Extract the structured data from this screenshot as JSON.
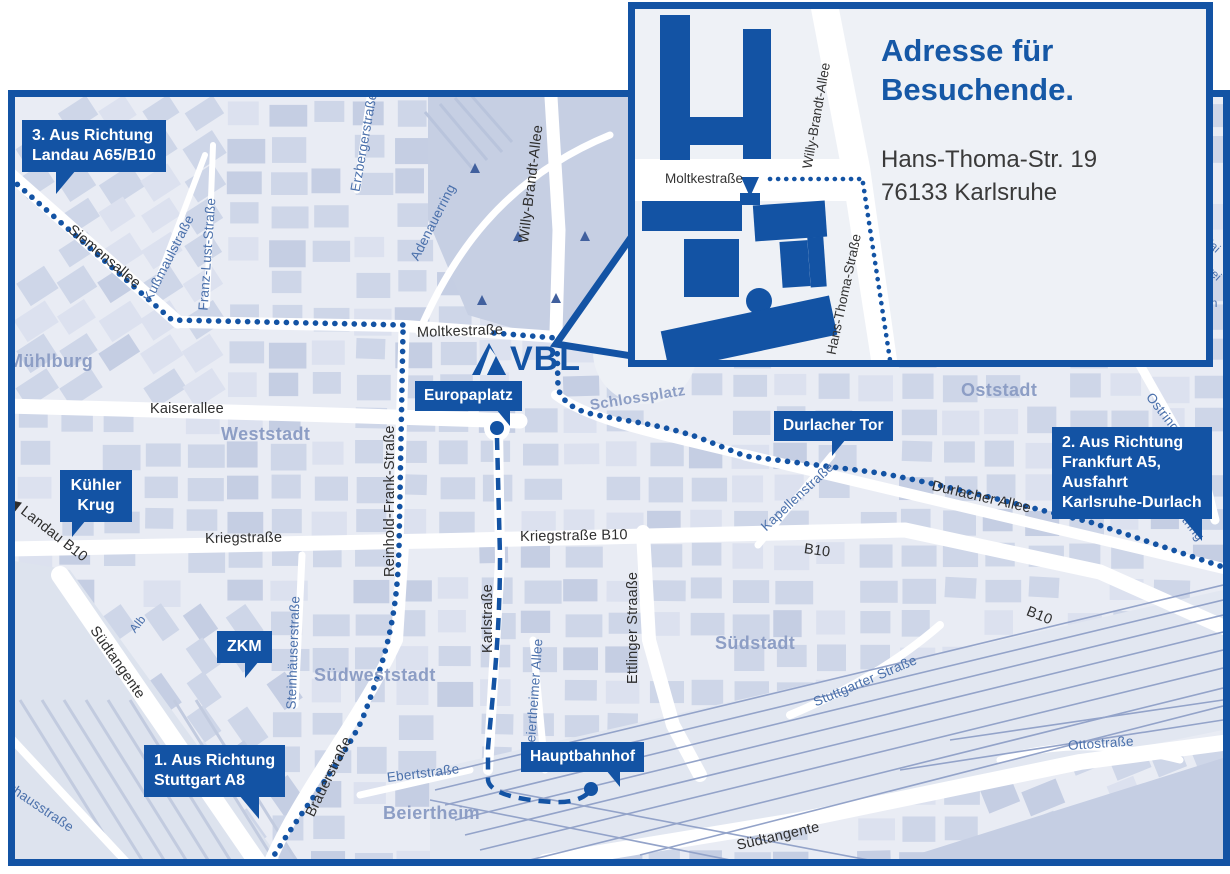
{
  "title": "VBL Anfahrtsplan Karlsruhe",
  "colors": {
    "accent": "#1353a4",
    "heading": "#1658a6",
    "mapBg": "#e9ecf4",
    "block": "#ced6e8",
    "blockLight": "#dce1ef",
    "blockDark": "#c5cee3",
    "park": "#c6cfe3",
    "railZone": "#e2e7f1",
    "rail": "#93a3c9",
    "district": "#8d9ec5",
    "streetDark": "#2e2e2e",
    "streetBlue": "#4a70ab",
    "insetBg": "#eef1f6",
    "addressText": "#3a3a3a"
  },
  "logo": {
    "text": "VBL"
  },
  "inset": {
    "heading": "Adresse für Besuchende.",
    "address_line1": "Hans-Thoma-Str. 19",
    "address_line2": "76133 Karlsruhe",
    "streets": [
      {
        "id": "moltke_inset",
        "label": "Moltkestraße"
      },
      {
        "id": "willy_inset",
        "label": "Willy-Brandt-Allee"
      },
      {
        "id": "hans_thoma_inset",
        "label": "Hans-Thoma-Straße"
      }
    ]
  },
  "callouts": {
    "route3": {
      "lines": [
        "3. Aus Richtung",
        "Landau A65/B10"
      ]
    },
    "kuehler_krug": {
      "lines": [
        "Kühler",
        "Krug"
      ]
    },
    "zkm": {
      "lines": [
        "ZKM"
      ]
    },
    "route1": {
      "lines": [
        "1. Aus Richtung",
        "Stuttgart A8"
      ]
    },
    "europaplatz": {
      "lines": [
        "Europaplatz"
      ]
    },
    "durlacher_tor": {
      "lines": [
        "Durlacher Tor"
      ]
    },
    "route2": {
      "lines": [
        "2. Aus Richtung",
        "Frankfurt A5,",
        "Ausfahrt",
        "Karlsruhe-Durlach"
      ]
    },
    "hauptbahnhof": {
      "lines": [
        "Hauptbahnhof"
      ]
    }
  },
  "districts": [
    {
      "id": "muehlburg",
      "label": "Mühlburg"
    },
    {
      "id": "weststadt",
      "label": "Weststadt"
    },
    {
      "id": "oststadt",
      "label": "Oststadt"
    },
    {
      "id": "suedstadt",
      "label": "Südstadt"
    },
    {
      "id": "suedweststadt",
      "label": "Südweststadt"
    },
    {
      "id": "beiertheim",
      "label": "Beiertheim"
    },
    {
      "id": "schlossplatz",
      "label": "Schlossplatz"
    }
  ],
  "streets": [
    {
      "id": "siemensallee",
      "label": "Siemensallee"
    },
    {
      "id": "kussmaulstrasse",
      "label": "Kußmaulstraße"
    },
    {
      "id": "franz_lust",
      "label": "Franz-Lust-Straße"
    },
    {
      "id": "erzbergerstrasse",
      "label": "Erzbergerstraße"
    },
    {
      "id": "kaiserallee",
      "label": "Kaiserallee"
    },
    {
      "id": "moltkestrasse",
      "label": "Moltkestraße"
    },
    {
      "id": "willy_brandt",
      "label": "Willy-Brandt-Allee"
    },
    {
      "id": "adenauerring",
      "label": "Adenauerring"
    },
    {
      "id": "kriegstrasse",
      "label": "Kriegstraße"
    },
    {
      "id": "kriegstrasse_b10",
      "label": "Kriegstraße B10"
    },
    {
      "id": "reinhold_frank",
      "label": "Reinhold-Frank-Straße"
    },
    {
      "id": "landau_b10",
      "label": "◀ Landau B10"
    },
    {
      "id": "karlstrasse",
      "label": "Karlstraße"
    },
    {
      "id": "ettlinger",
      "label": "Ettlinger Straaße"
    },
    {
      "id": "beiertheimer_allee",
      "label": "Beiertheimer Allee"
    },
    {
      "id": "steinhaeuser",
      "label": "Steinhäuserstraße"
    },
    {
      "id": "brauerstrasse",
      "label": "Brauerstraße"
    },
    {
      "id": "durlacher_allee",
      "label": "Durlacher Allee"
    },
    {
      "id": "kapellenstrasse",
      "label": "Kapellenstraße"
    },
    {
      "id": "b10_mid",
      "label": "B10"
    },
    {
      "id": "b10_right",
      "label": "B10"
    },
    {
      "id": "suedtangente_w",
      "label": "Südtangente"
    },
    {
      "id": "suedtangente_s",
      "label": "Südtangente"
    },
    {
      "id": "stuttgarter",
      "label": "Stuttgarter Straße"
    },
    {
      "id": "ottostrasse",
      "label": "Ottostraße"
    },
    {
      "id": "ebertstrasse",
      "label": "Ebertstraße"
    },
    {
      "id": "pulverhaus",
      "label": "Pulverhausstraße"
    },
    {
      "id": "alb",
      "label": "Alb"
    },
    {
      "id": "ostring_a",
      "label": "Ostring"
    },
    {
      "id": "ostring_b",
      "label": "Ostring"
    },
    {
      "id": "hai_partial",
      "label": "Hai"
    },
    {
      "id": "wei_partial",
      "label": "wei"
    },
    {
      "id": "ein_partial",
      "label": "ein"
    }
  ]
}
